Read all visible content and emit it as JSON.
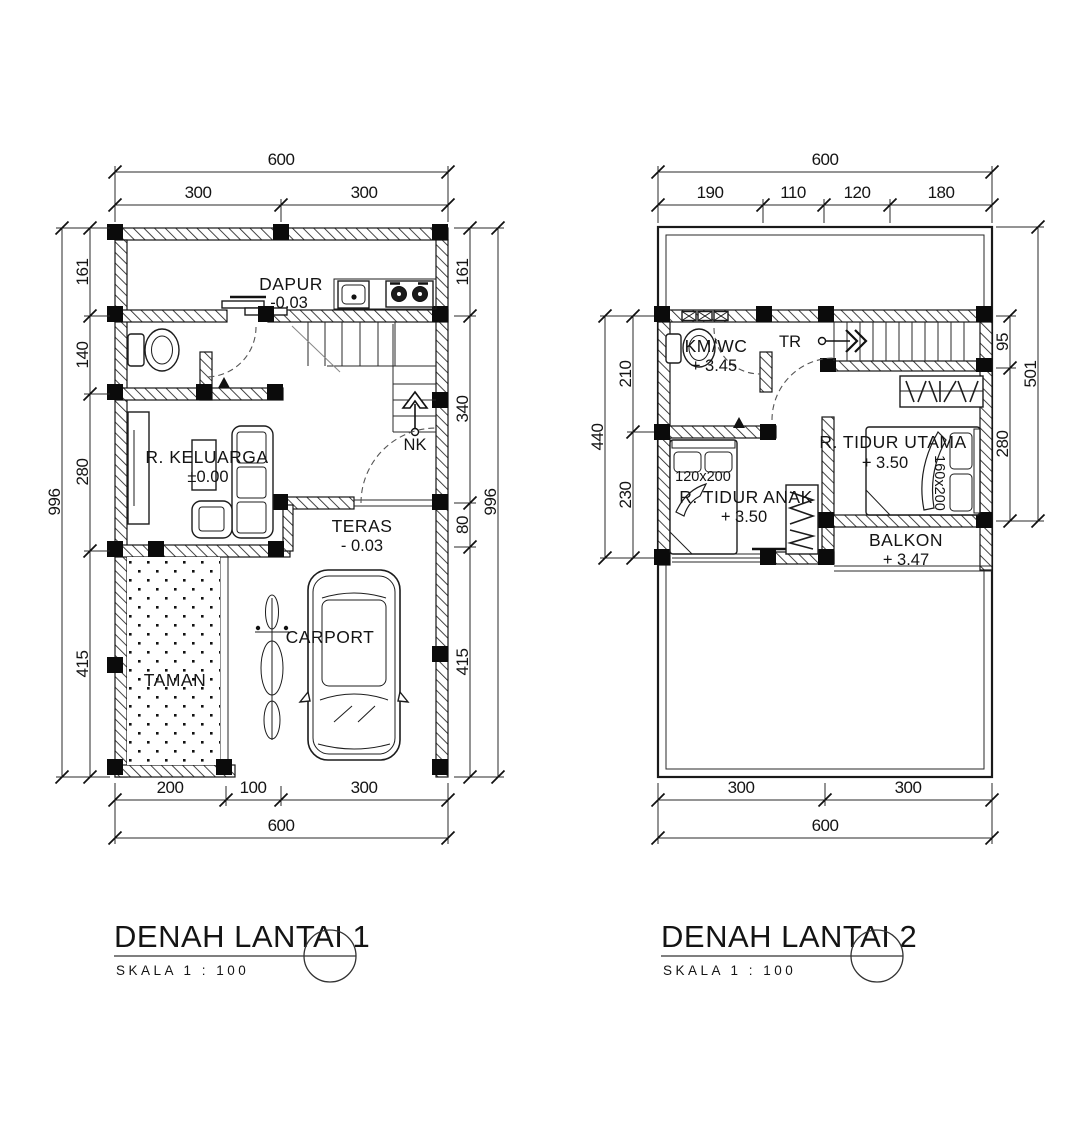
{
  "drawing": {
    "plan1": {
      "title": "DENAH LANTAI 1",
      "scale": "SKALA 1 : 100",
      "stair_label": "NK",
      "rooms": {
        "dapur": {
          "name": "DAPUR",
          "level": "-0.03"
        },
        "keluarga": {
          "name": "R. KELUARGA",
          "level": "±0.00"
        },
        "teras": {
          "name": "TERAS",
          "level": "- 0.03"
        },
        "taman": {
          "name": "TAMAN"
        },
        "carport": {
          "name": "CARPORT"
        }
      },
      "dims": {
        "top_total": "600",
        "top": [
          "300",
          "300"
        ],
        "left_total": "996",
        "left": [
          "161",
          "140",
          "280",
          "415"
        ],
        "right_total": "996",
        "right": [
          "161",
          "340",
          "80",
          "415"
        ],
        "bottom_total": "600",
        "bottom": [
          "200",
          "100",
          "300"
        ]
      }
    },
    "plan2": {
      "title": "DENAH LANTAI 2",
      "scale": "SKALA 1 : 100",
      "stair_label": "TR",
      "rooms": {
        "kmwc": {
          "name": "KM/WC",
          "level": "+ 3.45"
        },
        "tidur_utama": {
          "name": "R. TIDUR UTAMA",
          "level": "+ 3.50",
          "bed": "160x200"
        },
        "tidur_anak": {
          "name": "R. TIDUR ANAK",
          "level": "+ 3.50",
          "bed": "120x200"
        },
        "balkon": {
          "name": "BALKON",
          "level": "+ 3.47"
        }
      },
      "dims": {
        "top_total": "600",
        "top": [
          "190",
          "110",
          "120",
          "180"
        ],
        "left_total": "440",
        "left": [
          "210",
          "230"
        ],
        "right_outer": "501",
        "right": [
          "95",
          "280"
        ],
        "bottom_total": "600",
        "bottom": [
          "300",
          "300"
        ]
      }
    }
  }
}
